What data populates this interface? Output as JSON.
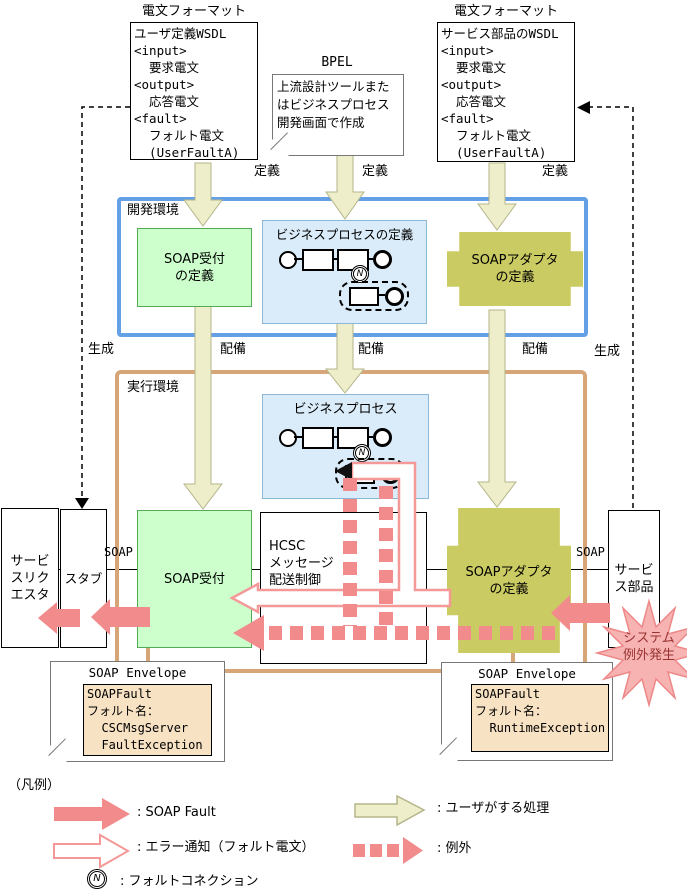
{
  "colors": {
    "dev_env_border": "#64a0e6",
    "exec_env_border": "#d6a678",
    "green_fill": "#ccffcc",
    "green_border": "#55aa55",
    "blue_fill": "#daecf9",
    "olive_fill": "#cbcb63",
    "yellow_arrow": "#eeeecb",
    "pink_arrow": "#f28c8c",
    "starburst_fill": "#f7b2b2",
    "tan_fill": "#f8e2c4"
  },
  "top": {
    "left_format_title": "電文フォーマット",
    "left_wsdl_lines": [
      "ユーザ定義WSDL",
      "<input>",
      "  要求電文",
      "<output>",
      "  応答電文",
      "<fault>",
      "  フォルト電文",
      "  (UserFaultA)"
    ],
    "bpel_title": "BPEL",
    "bpel_note_lines": [
      "上流設計ツールまた",
      "はビジネスプロセス",
      "開発画面で作成"
    ],
    "right_format_title": "電文フォーマット",
    "right_wsdl_lines": [
      "サービス部品のWSDL",
      "<input>",
      "  要求電文",
      "<output>",
      "  応答電文",
      "<fault>",
      "  フォルト電文",
      "  (UserFaultA)"
    ],
    "define_label": "定義"
  },
  "flow_labels": {
    "generate": "生成",
    "deploy": "配備"
  },
  "dev_env": {
    "title": "開発環境",
    "soap_reception_def_lines": [
      "SOAP受付",
      "の定義"
    ],
    "bp_def_title": "ビジネスプロセスの定義",
    "soap_adapter_def_lines": [
      "SOAPアダプタ",
      "の定義"
    ]
  },
  "exec_env": {
    "title": "実行環境",
    "bp_title": "ビジネスプロセス",
    "service_requester_lines": [
      "サービ",
      "スリク",
      "エスタ"
    ],
    "stub": "スタブ",
    "soap_label": "SOAP",
    "soap_reception": "SOAP受付",
    "hcsc_lines": [
      "HCSC",
      "メッセージ",
      "配送制御"
    ],
    "soap_adapter_lines": [
      "SOAPアダプタ",
      "の定義"
    ],
    "service_part_lines": [
      "サービ",
      "ス部品"
    ]
  },
  "system_exception_lines": [
    "システム",
    "例外発生"
  ],
  "envelope_left": {
    "title": "SOAP Envelope",
    "lines": [
      "SOAPFault",
      "フォルト名：",
      "  CSCMsgServer",
      "  FaultException"
    ]
  },
  "envelope_right": {
    "title": "SOAP Envelope",
    "lines": [
      "SOAPFault",
      "フォルト名：",
      "  RuntimeException"
    ]
  },
  "legend": {
    "title": "（凡例）",
    "soap_fault": ": SOAP Fault",
    "error_notice": ": エラー通知（フォルト電文）",
    "fault_connection": ": フォルトコネクション",
    "user_process": ": ユーザがする処理",
    "exception": ": 例外",
    "fault_connection_symbol": "N"
  }
}
